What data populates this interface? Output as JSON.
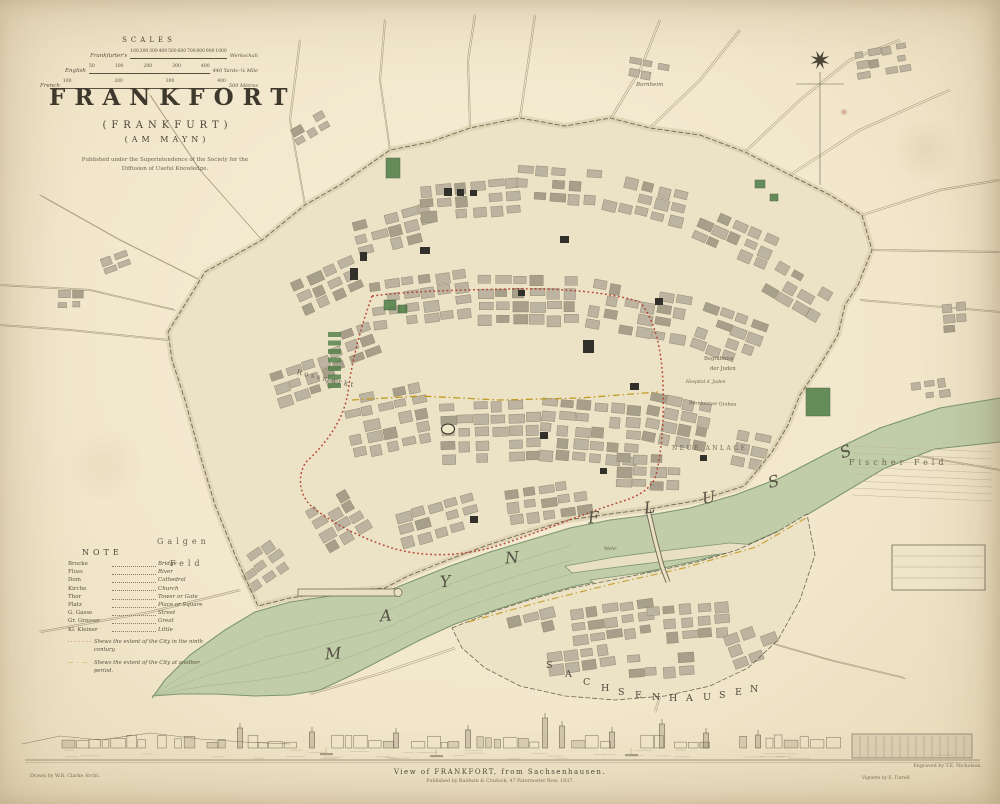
{
  "sheet": {
    "kind": "Antique engraved city plan, hand coloured"
  },
  "colors": {
    "paper": "#f2e7cc",
    "ink": "#5a5140",
    "water": "#c0cda8",
    "water_edge": "#7d9670",
    "ground": "#ece2c6",
    "block": "#bcb3a0",
    "block_dark": "#a89f8a",
    "red_line": "#b23527",
    "yellow_line": "#c19a22",
    "park": "#4e7d46",
    "landmark": "#32302a"
  },
  "title": {
    "main": "FRANKFORT",
    "alt": "(FRANKFURT)",
    "alt2": "(AM MAYN)",
    "imprint": "Published under the Superintendence of the Society for the Diffusion of Useful Knowledge."
  },
  "scales": {
    "heading": "SCALES",
    "bars": [
      {
        "label": "Frankfurter's",
        "ticks": [
          "100",
          "200",
          "300",
          "400",
          "500",
          "600",
          "700",
          "800",
          "900",
          "1000"
        ],
        "unit": "Werkschuh"
      },
      {
        "label": "English",
        "ticks": [
          "50",
          "100",
          "200",
          "300",
          "400"
        ],
        "unit": "440 Yards–¼ Mile"
      },
      {
        "label": "French",
        "ticks": [
          "100",
          "200",
          "300",
          "400"
        ],
        "unit": "500 Mètres"
      }
    ]
  },
  "note": {
    "heading": "NOTE",
    "entries": [
      {
        "term": "Brucke",
        "meaning": "Bridge"
      },
      {
        "term": "Fluss",
        "meaning": "River"
      },
      {
        "term": "Dom",
        "meaning": "Cathedral"
      },
      {
        "term": "Kirche",
        "meaning": "Church"
      },
      {
        "term": "Thor",
        "meaning": "Tower or Gate"
      },
      {
        "term": "Platz",
        "meaning": "Place or Square"
      },
      {
        "term": "G. Gasse",
        "meaning": "Street"
      },
      {
        "term": "Gr. Grosser",
        "meaning": "Great"
      },
      {
        "term": "Kl. Kleiner",
        "meaning": "Little"
      }
    ],
    "wall_notes": [
      {
        "marker": "dotted-red",
        "text": "Shews the extent of the City in the ninth century."
      },
      {
        "marker": "dash-dot-yellow",
        "text": "Shews the extent of the City at another period."
      }
    ]
  },
  "map_labels": {
    "galgen_1": "Galgen",
    "galgen_2": "Feld",
    "fischer_feld": "Fischer Feld",
    "rossmarkt": "Rossmarkt",
    "neue_anlage": "NEUE ANLAGE",
    "begrabniss_1": "Begräbniss",
    "begrabniss_2": "der Juden",
    "hospital": "Hospital d. Juden",
    "bornheimer_graben": "Bornheimer Graben",
    "bornheim": "Bornheim",
    "wehr": "Wehr",
    "river_word_1": "MAYN",
    "river_word_2": "FLUSS",
    "district": "SACHSENHAUSEN"
  },
  "vignette": {
    "caption": "View of FRANKFORT, from Sachsenhausen.",
    "publisher": "Published by Baldwin & Cradock, 47 Paternoster Row, 1837.",
    "credit_drawn": "Drawn by W.B. Clarke Archt.",
    "credit_engraved": "Engraved by T.E. Nicholson.",
    "credit_vignette": "Vignette by E. Turrell."
  }
}
